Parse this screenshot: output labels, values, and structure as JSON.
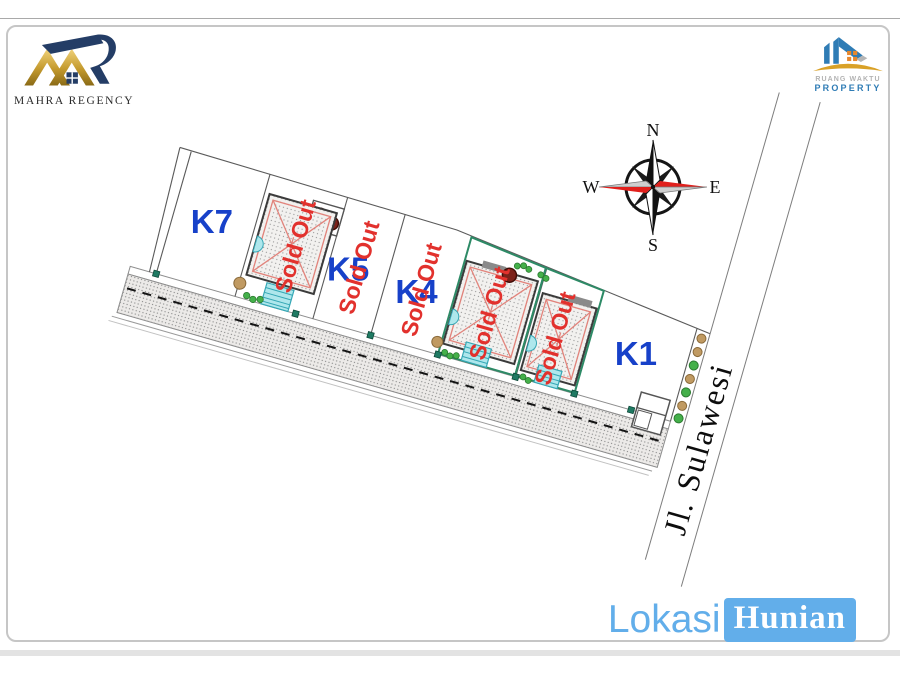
{
  "header": {
    "left_logo": {
      "name": "MAHRA REGENCY"
    },
    "right_logo": {
      "line1": "RUANG WAKTU",
      "line2": "PROPERTY"
    }
  },
  "compass": {
    "n": "N",
    "s": "S",
    "e": "E",
    "w": "W"
  },
  "plan": {
    "road_label": "Jl. Sulawesi",
    "lots": [
      {
        "label": "K7",
        "status": ""
      },
      {
        "label": "",
        "status": "Sold Out"
      },
      {
        "label": "K5",
        "status": "Sold Out"
      },
      {
        "label": "K4",
        "status": "Sold Out"
      },
      {
        "label": "",
        "status": "Sold Out"
      },
      {
        "label": "",
        "status": "Sold Out"
      },
      {
        "label": "K1",
        "status": ""
      }
    ]
  },
  "footer": {
    "word1": "Lokasi",
    "word2": "Hunian"
  },
  "colors": {
    "lot_label_blue": "#1741c9",
    "sold_out_red": "#e2312d",
    "footer_blue": "#62aeea",
    "brand_gold": "#c49a2e",
    "brand_navy": "#243d66",
    "green_lot_border": "#2d8a66",
    "stairs_cyan": "#aee7ec",
    "compass_red": "#e1201c"
  }
}
